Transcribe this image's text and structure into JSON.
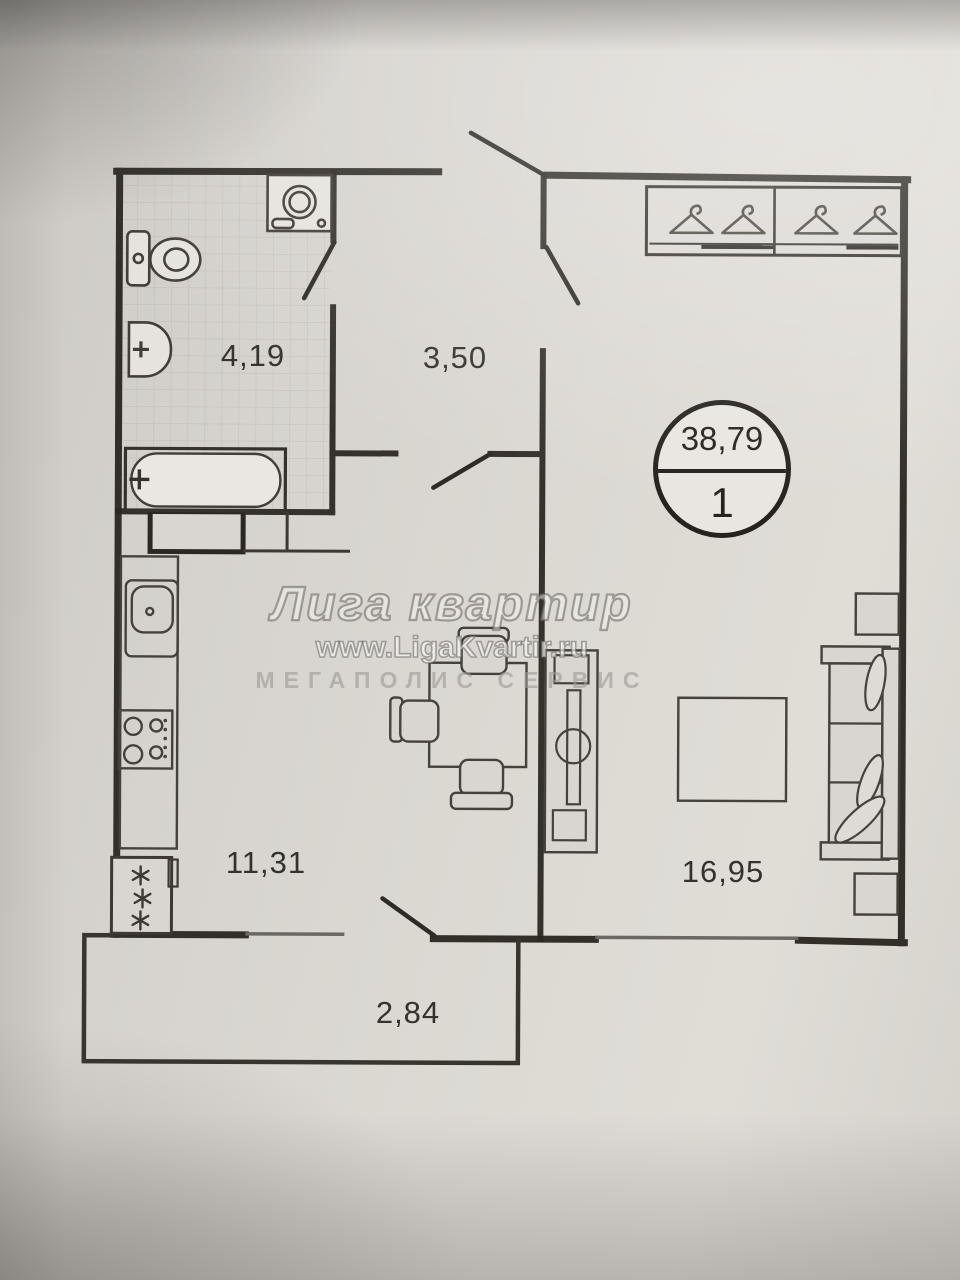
{
  "plan": {
    "type": "apartment-floor-plan",
    "badge": {
      "total_area": "38,79",
      "rooms_count": "1"
    },
    "rooms": [
      {
        "id": "bathroom",
        "area": "4,19"
      },
      {
        "id": "hallway",
        "area": "3,50"
      },
      {
        "id": "kitchen",
        "area": "11,31"
      },
      {
        "id": "living-room",
        "area": "16,95"
      },
      {
        "id": "balcony",
        "area": "2,84"
      }
    ],
    "fixtures": {
      "bathroom": [
        "washing-machine",
        "toilet",
        "wash-basin",
        "bathtub",
        "vent-shaft"
      ],
      "kitchen": [
        "counter",
        "kitchen-sink",
        "stove",
        "fridge",
        "dining-table",
        "chairs"
      ],
      "living_room": [
        "wardrobe-with-hangers",
        "tv-stand",
        "coffee-table",
        "sofa-with-pillows",
        "side-tables"
      ]
    },
    "colors": {
      "ink": "#2b2822",
      "paper": "#d8d5d0",
      "window": "#6b6762"
    }
  },
  "watermark": {
    "brand": "Лига квартир",
    "url": "www.LigaKvartir.ru",
    "subtitle": "МЕГАПОЛИС СЕРВИС"
  }
}
